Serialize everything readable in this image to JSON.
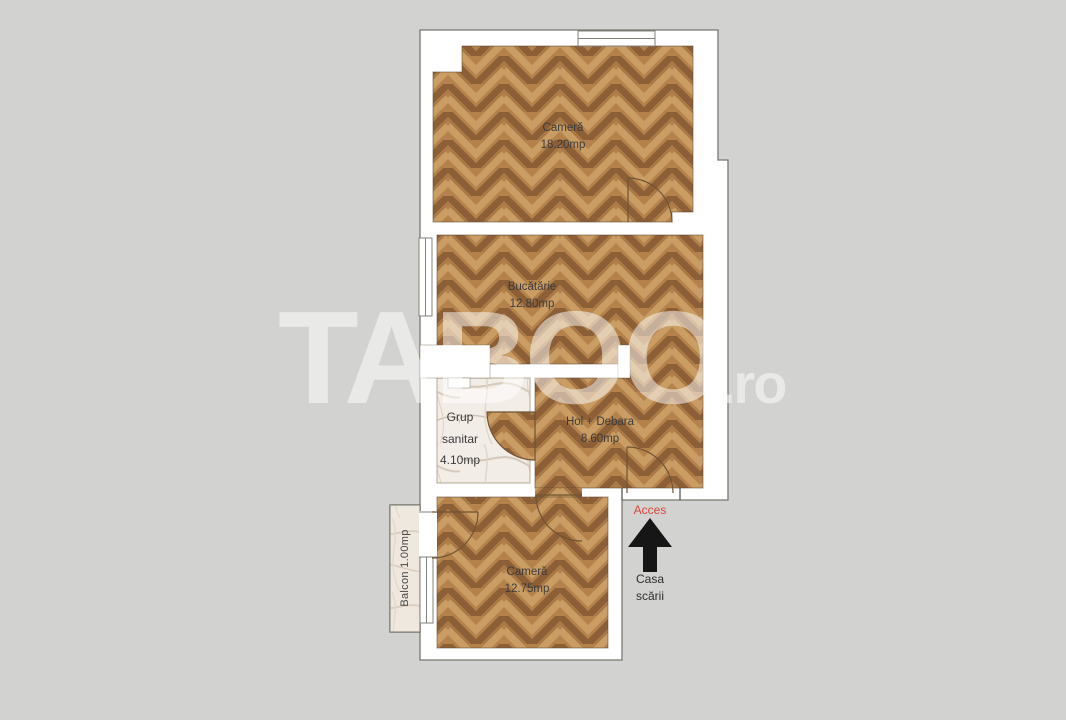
{
  "watermark": {
    "text": "TABOO",
    "suffix": ".ro"
  },
  "rooms": {
    "camera_top": {
      "name": "Cameră",
      "area": "18.20mp"
    },
    "bucatarie": {
      "name": "Bucătărie",
      "area": "12.80mp"
    },
    "grup_sanitar": {
      "line1": "Grup",
      "line2": "sanitar",
      "area": "4.10mp"
    },
    "hol_debara": {
      "name": "Hol + Debara",
      "area": "8.60mp"
    },
    "camera_bottom": {
      "name": "Cameră",
      "area": "12.75mp"
    },
    "balcon": {
      "label": "Balcon 1.00mp"
    }
  },
  "entrance": {
    "access_label": "Acces",
    "arrow_icon": "up-arrow",
    "staircase_line1": "Casa",
    "staircase_line2": "scării"
  },
  "colors": {
    "background": "#d2d3d0",
    "wall_white": "#ffffff",
    "wood_base": "#b5824c",
    "wood_dark": "#8d5f36",
    "wood_light": "#c99d63",
    "marble_base": "#f2ede7",
    "marble_vein": "#d5c9bb",
    "balcony_tint": "#e8dfd2",
    "accent_red": "#d9453b",
    "arrow_black": "#161616"
  }
}
